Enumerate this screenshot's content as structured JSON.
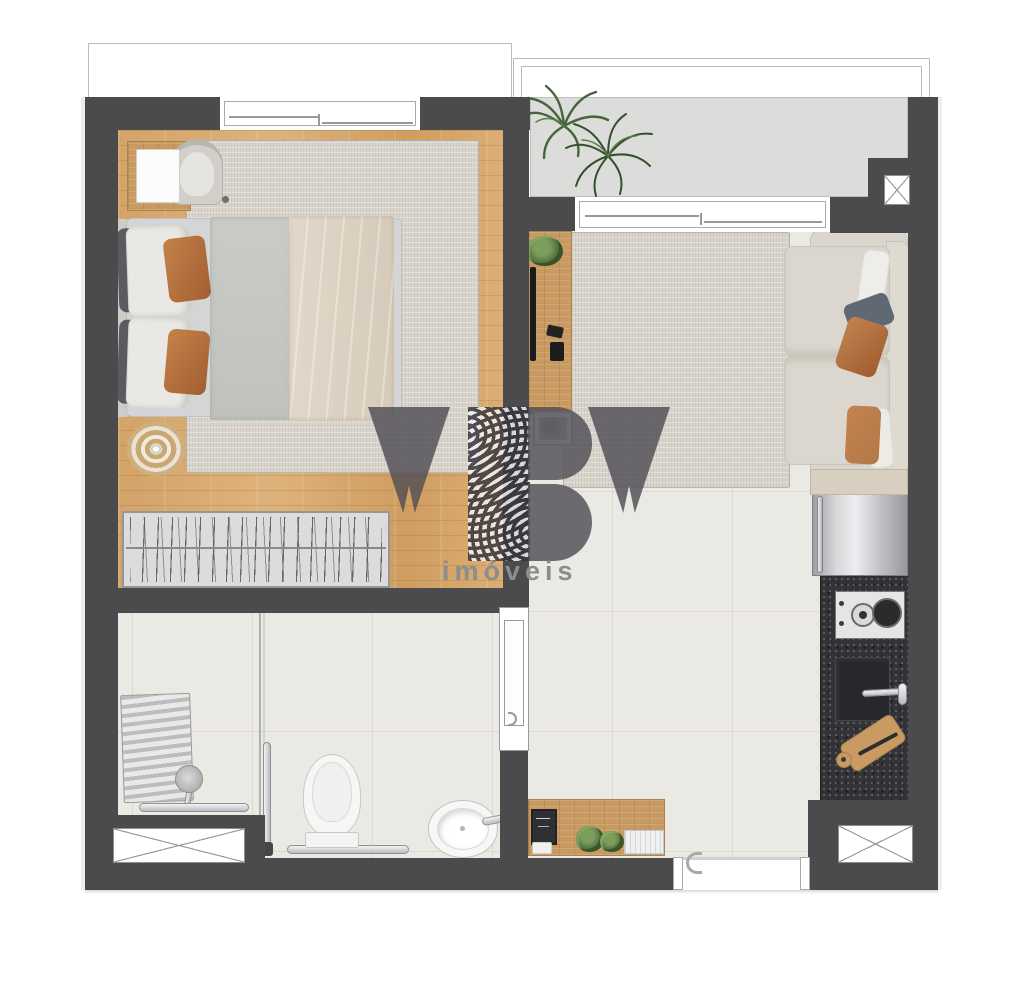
{
  "watermark": {
    "brand_letters": "YBY",
    "tagline": "imóveis"
  },
  "palette": {
    "wall": "#4b4b4d",
    "wood_floor": "#d6a96e",
    "wood_furniture": "#c89a62",
    "tile_floor": "#ebe9e4",
    "balcony_floor": "#dcdcda",
    "rug": "#d8d4cb",
    "counter_granite": "#323237",
    "accent_pillow_orange": "#bd7f4c",
    "logo_gray": "#504e56",
    "tagline_gray": "#8d8d8d"
  },
  "fixtures": [
    "double-bed",
    "nightstand",
    "armchair",
    "round-rug",
    "wardrobe",
    "palm-plant",
    "tv-console",
    "picture-frame",
    "sofa",
    "side-table",
    "fridge",
    "cooktop",
    "kitchen-sink",
    "cutting-board",
    "shower-bench",
    "shower-head",
    "grab-bars",
    "toilet",
    "bathroom-sink",
    "sliding-door",
    "entry-door",
    "sideboard",
    "air-shafts",
    "windows"
  ]
}
